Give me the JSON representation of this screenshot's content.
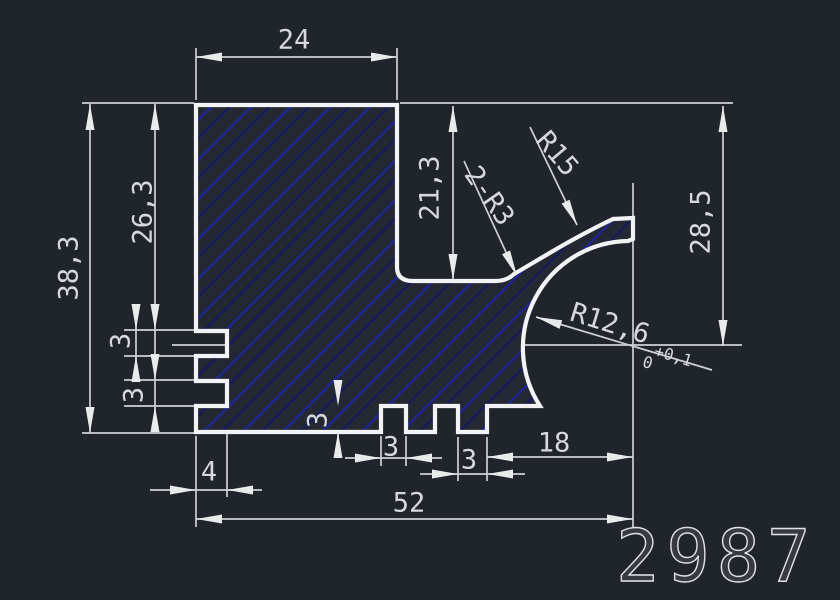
{
  "title_number": "2987",
  "colors": {
    "background": "#20252c",
    "outline": "#f2f3f4",
    "hatch_main": "#1f2399",
    "hatch_faint": "#161a5e",
    "dimension_lines": "#cdd1d5",
    "dimension_text": "#d6d9db"
  },
  "dims": {
    "top_width": "24",
    "total_height": "38,3",
    "upper_height": "26,3",
    "slot1_height": "3",
    "slot2_height": "3",
    "channel_depth": "21,3",
    "fillet_note": "2-R3",
    "outer_radius": "R15",
    "right_height": "28,5",
    "groove_radius": "R12,6",
    "groove_tol_upper": "+0,1",
    "groove_tol_lower": "0",
    "step_height": "3",
    "notch_width": "3",
    "tooth_width": "3",
    "slot_depth": "4",
    "right_offset": "18",
    "total_width": "52"
  }
}
